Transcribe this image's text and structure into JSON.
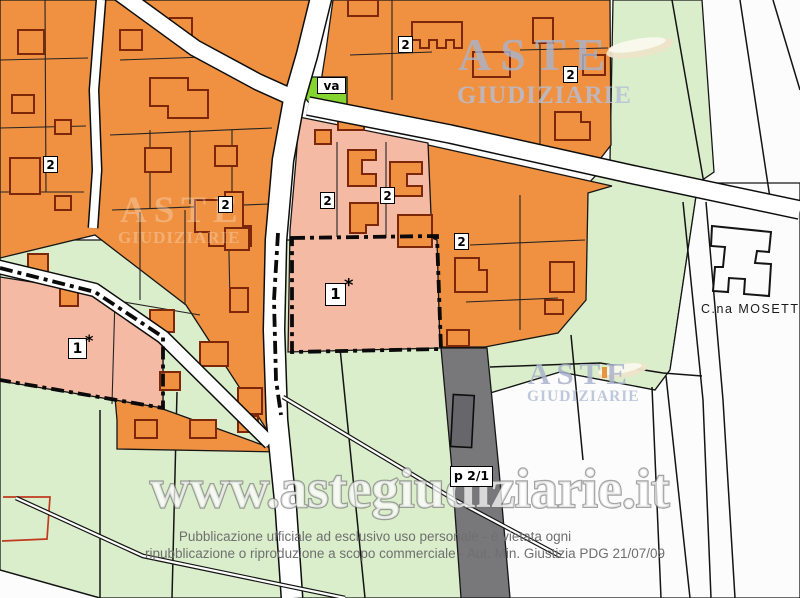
{
  "map": {
    "locality_label": "C.na MOSETT",
    "labels": {
      "zone2": "2",
      "va": "va",
      "subject": "1",
      "star": "*",
      "strip": "p 2/1"
    },
    "colors": {
      "urban_orange": "#EF9140",
      "parcel_pink": "#F5BAA3",
      "field_green": "#DBEECB",
      "public_green": "#86D430",
      "strip_gray": "#78787B",
      "strip_building_gray": "#66666B",
      "building_outline": "#7B2708",
      "boundary_black": "#0A0A0A",
      "road_white": "#FFFFFF",
      "red_boundary": "#C03A20",
      "logo_blue": "#A9B4CC",
      "swoosh_beige": "#EDE4C9"
    }
  },
  "watermarks": {
    "logo_top": {
      "line1": "ASTE",
      "line2": "GIUDIZIARIE"
    },
    "logo_mid": {
      "line1": "ASTE",
      "line2": "GIUDIZIARIE"
    },
    "logo_faint": {
      "line1": "ASTE",
      "line2": "GIUDIZIARIE"
    },
    "url": "www.astegiudiziarie.it"
  },
  "footer": {
    "line1": "Pubblicazione ufficiale ad esclusivo uso personale - è vietata ogni",
    "line2": "ripubblicazione o riproduzione a scopo commerciale - Aut. Min. Giustizia PDG 21/07/09"
  }
}
